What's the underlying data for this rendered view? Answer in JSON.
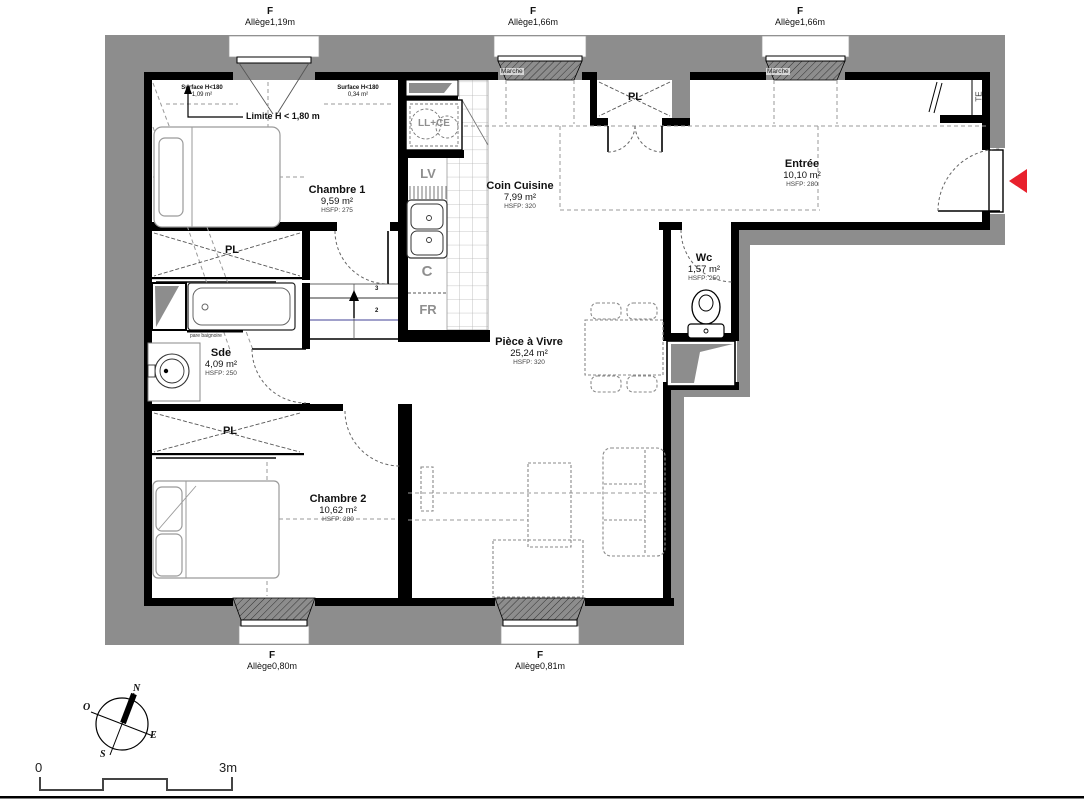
{
  "plan": {
    "windows": {
      "top1": {
        "f": "F",
        "sub": "Allège1,19m"
      },
      "top2": {
        "f": "F",
        "sub": "Allège1,66m"
      },
      "top3": {
        "f": "F",
        "sub": "Allège1,66m"
      },
      "bottom1": {
        "f": "F",
        "sub": "Allège0,80m"
      },
      "bottom2": {
        "f": "F",
        "sub": "Allège0,81m"
      }
    },
    "rooms": [
      {
        "name": "Chambre 1",
        "area": "9,59 m²",
        "hsfp": "HSFP: 275"
      },
      {
        "name": "Coin Cuisine",
        "area": "7,99 m²",
        "hsfp": "HSFP: 320"
      },
      {
        "name": "Entrée",
        "area": "10,10 m²",
        "hsfp": "HSFP: 280"
      },
      {
        "name": "Wc",
        "area": "1,57 m²",
        "hsfp": "HSFP: 250"
      },
      {
        "name": "Sde",
        "area": "4,09 m²",
        "hsfp": "HSFP: 250"
      },
      {
        "name": "Pièce à Vivre",
        "area": "25,24 m²",
        "hsfp": "HSFP: 320"
      },
      {
        "name": "Chambre 2",
        "area": "10,62 m²",
        "hsfp": "HSFP: 280"
      }
    ],
    "closets": {
      "label": "PL"
    },
    "annotations": {
      "surface1": {
        "line1": "Surface H<180",
        "line2": "1,09 m²"
      },
      "surface2": {
        "line1": "Surface H<180",
        "line2": "0,34 m²"
      },
      "limite": "Limite H < 1,80 m",
      "marche": "Marche",
      "pare_baignoire": "pare baignoire",
      "step2": "2",
      "step3": "3"
    },
    "appliances": {
      "ll_ce": "LL+CE",
      "lv": "LV",
      "c": "C",
      "fr": "FR",
      "te": "TE"
    },
    "compass": {
      "n": "N",
      "s": "S",
      "e": "E",
      "o": "O"
    },
    "scale": {
      "zero": "0",
      "max": "3m"
    },
    "colors": {
      "wall_gray": "#8d8d8d",
      "wall_black": "#000000",
      "arrow_red": "#e8212d",
      "stair_blue": "#8080b8"
    }
  }
}
